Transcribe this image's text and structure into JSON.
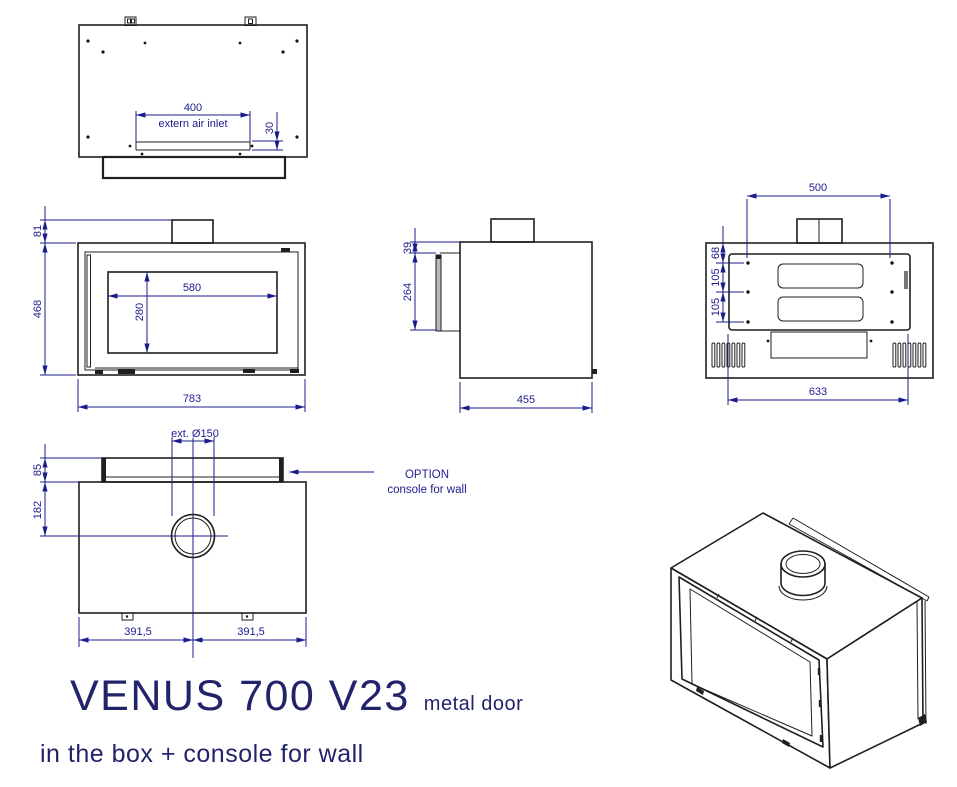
{
  "title": {
    "model": "VENUS 700 V23",
    "variant": "metal door",
    "subtitle": "in the box + console for wall"
  },
  "colors": {
    "dimension_blue": "#1c1c8f",
    "drawing_black": "#1f1f1f",
    "title_navy": "#23236b",
    "background": "#ffffff"
  },
  "views": {
    "top": {
      "dim_air_inlet_width": "400",
      "air_inlet_label": "extern air inlet",
      "dim_inlet_offset": "30"
    },
    "front": {
      "dim_flue_stub_height": "81",
      "dim_height": "468",
      "dim_glass_width": "580",
      "dim_glass_height": "280",
      "dim_width": "783"
    },
    "side": {
      "dim_door_top_offset": "39",
      "dim_door_height": "264",
      "dim_depth": "455"
    },
    "rear": {
      "dim_bracket_span": "500",
      "dim_hole_top_offset": "68",
      "dim_hole_spacing_upper": "105",
      "dim_hole_spacing_lower": "105",
      "dim_bottom_span": "633"
    },
    "bottom": {
      "dim_flue_diameter": "ext. Ø150",
      "dim_console_depth": "85",
      "dim_flue_center_offset": "182",
      "dim_half_width_left": "391,5",
      "dim_half_width_right": "391,5"
    },
    "option": {
      "line1": "OPTION",
      "line2": "console for wall"
    }
  }
}
